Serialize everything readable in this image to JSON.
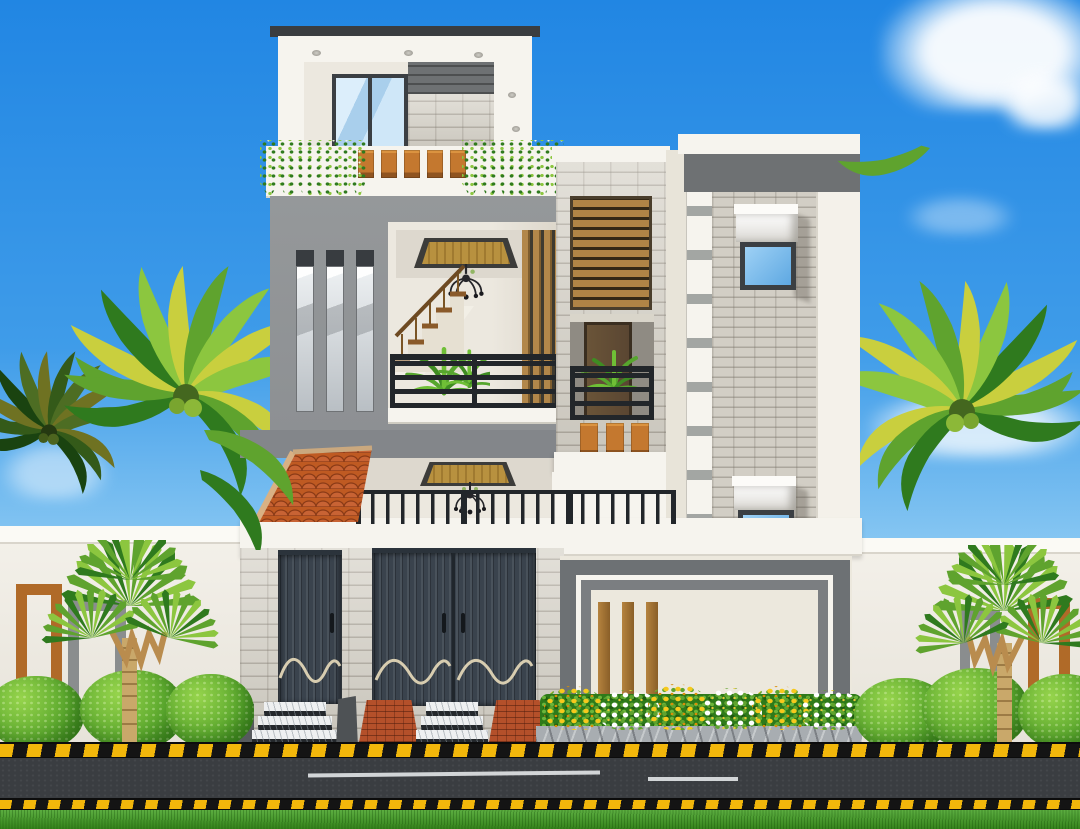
{
  "scene": {
    "type": "3d-architectural-elevation-render",
    "description": "Front elevation of a modern three-storey house with white parapets, gray feature wall, split-face stone cladding, wooden slat accents, terracotta tiled porch awning, dark garage gates, compound wall, palm trees, shrubs, flower bed and street",
    "sky": {
      "clouds": 5
    },
    "house": {
      "floors": 3,
      "rooftop_pavilion": {
        "glass_door_panels": 2,
        "soffit_lights": 3,
        "cladding": [
          "white-parapet",
          "dark-stone-band",
          "light-stone"
        ]
      },
      "terrace": {
        "planter_boxes": 5,
        "hanging_ivy_clusters": 2
      },
      "second_floor": {
        "slit_windows": 3,
        "balcony": {
          "chandelier": true,
          "staircase_steps": 5,
          "railing_style": "black horizontal bars",
          "ceiling_panel": "wood with dark border",
          "plant": true,
          "wood_slat_wall": true
        }
      },
      "middle_tower": {
        "wood_slat_screen": true,
        "balcony_door": "dark wood",
        "hanging_planters": 3,
        "ledge": true
      },
      "right_tower": {
        "awning_windows": 2,
        "cladding": "split-face stone",
        "pilaster_blocks": 9,
        "top_band": "dark gray"
      },
      "ground_floor": {
        "garage_gates": 2,
        "gate_style": "dark vertical ribs with cream wave trim",
        "gate_handles": 3,
        "porch_chandelier": true,
        "tiled_awning": "terracotta hip roof",
        "picket_railing": true,
        "entry_step_flights": 2,
        "brick_ramps": 2,
        "right_wing": {
          "gray_trim_bands": 2,
          "wood_slat_accents": 3
        }
      }
    },
    "landscape": {
      "palm_trees": 2,
      "background_palm": 1,
      "fan_palms": 2,
      "shrub_balls": 6,
      "flower_clusters": {
        "yellow": 3,
        "white": 3
      },
      "compound_wall_frames": {
        "rust": 2,
        "gray": 2
      }
    },
    "street": {
      "hazard_stripe_bands": 2,
      "road_markings": 2,
      "grass_verge": true
    }
  },
  "colors": {
    "sky-top": "#2186e3",
    "sky-mid": "#3f9ce9",
    "sky-horizon": "#8ecbf3",
    "cloud": "#ffffff",
    "wall-white": "#f4f1ea",
    "wall-coping": "#fbfaf5",
    "wall-shade": "#d9d5cb",
    "parapet-white": "#f6f4ee",
    "cream": "#ece8dd",
    "cream-side": "#e8e4d9",
    "gray-wall": "#8d9093",
    "slab-gray": "#83868a",
    "band-gray": "#6d7174",
    "band-gray2": "#7b7e81",
    "dark-band": "#6e7173",
    "frame-dark": "#3b3f43",
    "stone-base": "#d8d4ca",
    "brick-base": "#d2cec5",
    "gate-dark": "#3a434d",
    "gate-trim": "#d8cdb0",
    "accent-orange": "#c4782f",
    "accent-rust": "#b06a28",
    "wood": "#b08446",
    "wood-dark": "#6e5227",
    "door-wood": "#5a4632",
    "panel-wood": "#b8913f",
    "glass-blue": "#7cc0f0",
    "glass-pale": "#cfe7f8",
    "railing-black": "#22262a",
    "tile-red": "#bf5a22",
    "tile-dark": "#8a3a16",
    "ridge-tan": "#d9b184",
    "leaf-light": "#8cc63f",
    "leaf-mid": "#5fa32e",
    "leaf-dark": "#2f7a1e",
    "leaf-yellow": "#c9cf3e",
    "trunk-tan": "#c9a86a",
    "grass": "#41a021",
    "road": "#3a3d41",
    "stripe-yellow": "#f2b70b",
    "stripe-black": "#141414",
    "marble": "#eef0f1",
    "riser-dark": "#24282c",
    "ramp-brick": "#b4502a",
    "flower-yellow": "#f6c91c",
    "flower-white": "#ffffff",
    "curb-stone": "#a8adb1",
    "interior-wall": "#ece8df",
    "ceiling": "#ddd8ce"
  }
}
